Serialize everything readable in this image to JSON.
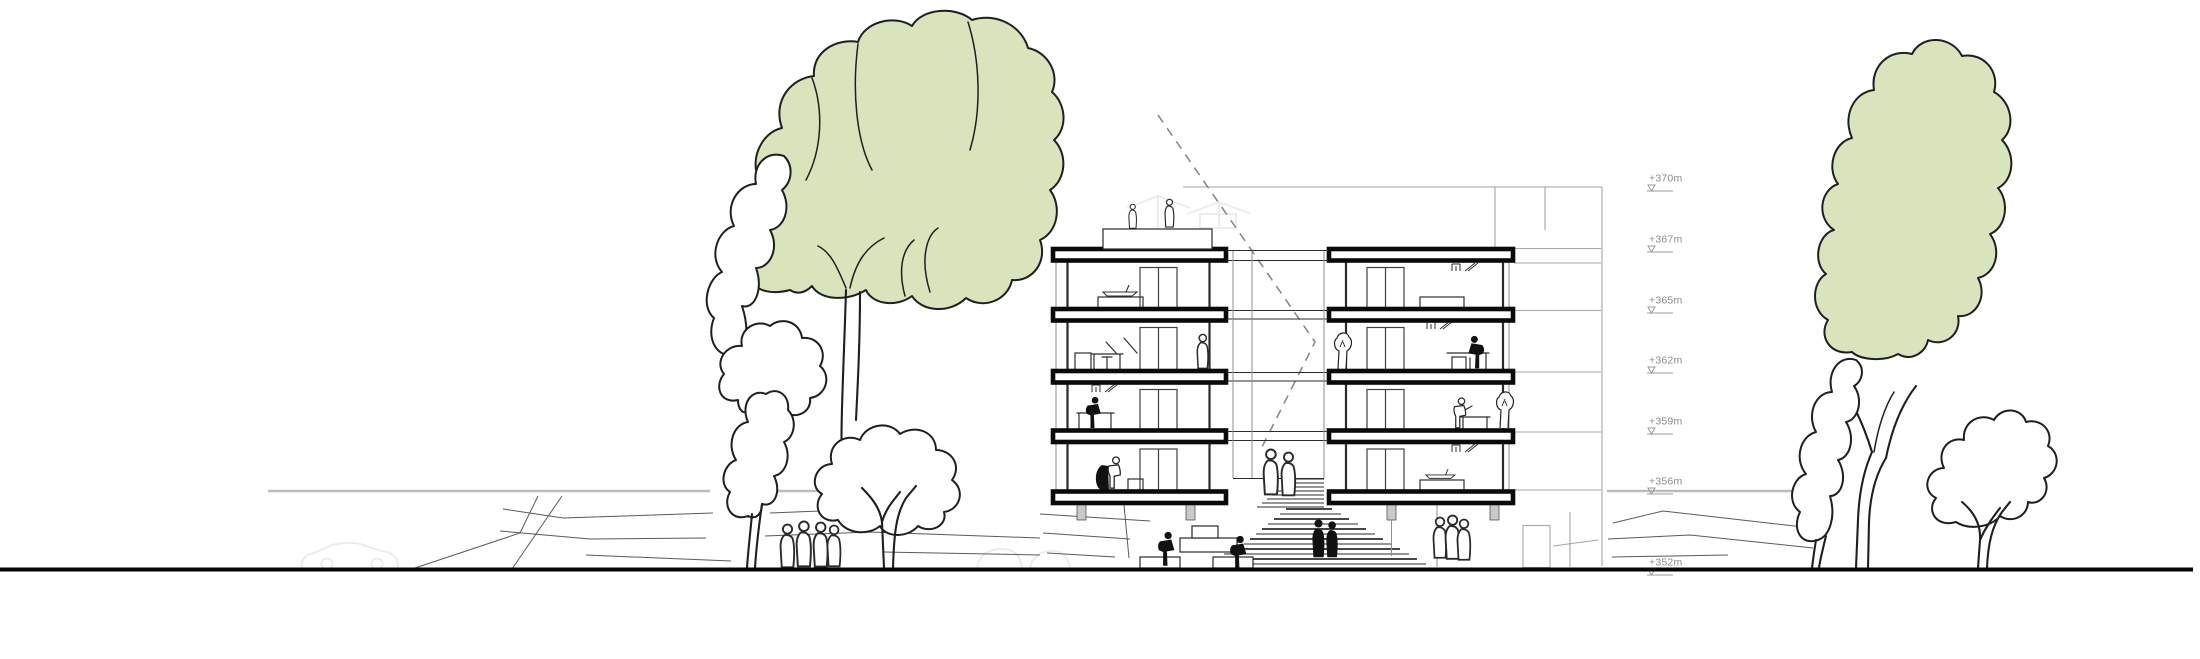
{
  "drawing": {
    "kind": "architectural cross-section / elevation",
    "scene": "two 4-storey sectioned apartment blocks over an amphitheatre stair, large sketched trees left and right, background building, ground line"
  },
  "elevation_scale": {
    "labels": [
      "+370m",
      "+367m",
      "+365m",
      "+362m",
      "+359m",
      "+356m",
      "+352m"
    ]
  },
  "colors": {
    "ink": "#1f1f1f",
    "canopy": "#d9e4bd",
    "slab": "#0a0a0a",
    "struct": "#2b2b2b",
    "lite": "#8f8f8f",
    "bg-line": "#a6a6a6",
    "level": "#bcbcbc",
    "ghost": "#ececec",
    "label": "#8a8a8a",
    "dash": "#8a8a8a",
    "terrain": "#5a5a5a"
  }
}
